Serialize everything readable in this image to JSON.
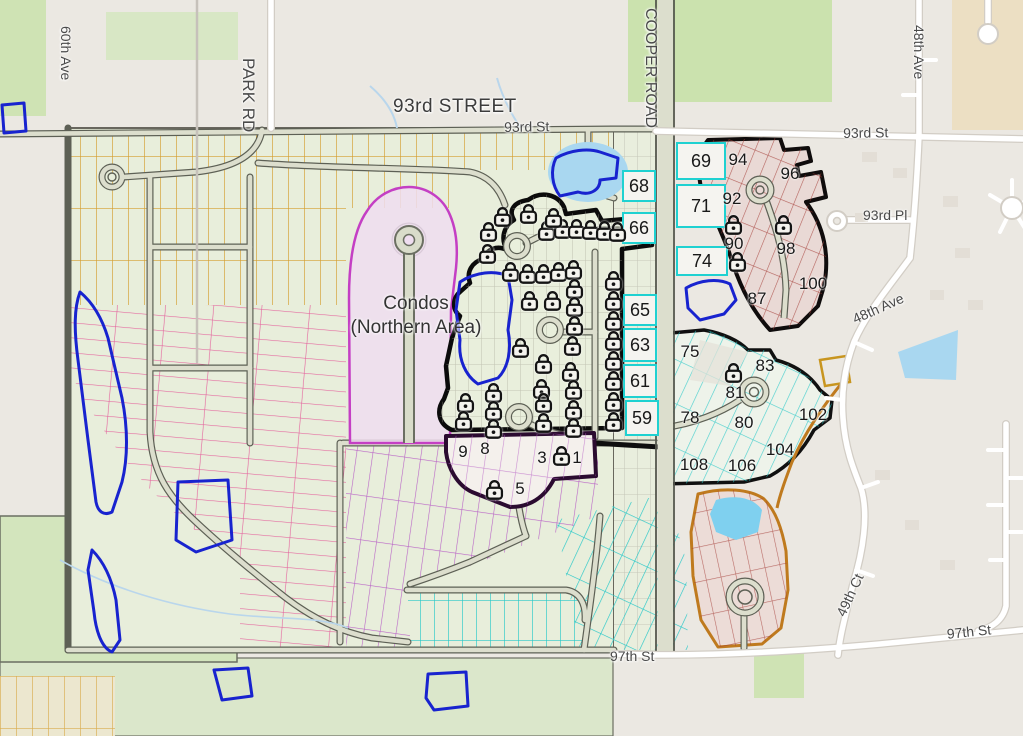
{
  "map_title": "Community site plan with lot availability",
  "colors": {
    "available_lot_border": "#1fd1d1",
    "locked_area_outline": "#0b0b0b",
    "condo_boundary": "#c43fc4",
    "red_phase_lines": "#9b2c2c",
    "orange_boundary": "#bf7a1e",
    "yellow_lot_lines": "#d49d2e",
    "pink_lot_lines": "#e4669e",
    "purple_lot_lines": "#b964c6",
    "pond_outline": "#1823cf",
    "water_fill": "#a9d7f0",
    "park_green": "#cfe3b4"
  },
  "area_labels": [
    {
      "id": "condos-northern-area",
      "text": "Condos\n(Northern Area)",
      "x": 336,
      "y": 292,
      "w": 160
    }
  ],
  "street_labels": [
    {
      "id": "60th-ave",
      "text": "60th Ave",
      "x": 74,
      "y": 26,
      "rot": 90,
      "size": 14
    },
    {
      "id": "park-rd",
      "text": "PARK RD",
      "x": 258,
      "y": 58,
      "rot": 90,
      "size": 17
    },
    {
      "id": "93rd-street",
      "text": "93rd STREET",
      "x": 393,
      "y": 96,
      "rot": 0,
      "size": 19,
      "big": true
    },
    {
      "id": "93rd-st-w",
      "text": "93rd St",
      "x": 504,
      "y": 119,
      "rot": -1,
      "size": 14
    },
    {
      "id": "cooper-road",
      "text": "COOPER ROAD",
      "x": 659,
      "y": 8,
      "rot": 90,
      "size": 16
    },
    {
      "id": "48th-ave-n",
      "text": "48th Ave",
      "x": 927,
      "y": 25,
      "rot": 90,
      "size": 14
    },
    {
      "id": "93rd-st-e",
      "text": "93rd St",
      "x": 843,
      "y": 125,
      "rot": -1,
      "size": 14
    },
    {
      "id": "93rd-pl",
      "text": "93rd Pl",
      "x": 863,
      "y": 207,
      "rot": 0,
      "size": 14
    },
    {
      "id": "48th-ave-s",
      "text": "48th Ave",
      "x": 850,
      "y": 312,
      "rot": -24,
      "size": 14
    },
    {
      "id": "49th-ct",
      "text": "49th Ct",
      "x": 833,
      "y": 612,
      "rot": -65,
      "size": 14
    },
    {
      "id": "97th-st-e",
      "text": "97th St",
      "x": 946,
      "y": 626,
      "rot": -6,
      "size": 14
    },
    {
      "id": "97th-st-w",
      "text": "97th St",
      "x": 610,
      "y": 648,
      "rot": 0,
      "size": 14
    }
  ],
  "available_lots": [
    {
      "num": "69",
      "x": 676,
      "y": 142,
      "w": 50,
      "h": 38,
      "style": "chip"
    },
    {
      "num": "71",
      "x": 676,
      "y": 184,
      "w": 50,
      "h": 44,
      "style": "chip"
    },
    {
      "num": "74",
      "x": 676,
      "y": 246,
      "w": 52,
      "h": 30,
      "style": "chip"
    },
    {
      "num": "68",
      "x": 622,
      "y": 170,
      "w": 34,
      "h": 32,
      "style": "chip"
    },
    {
      "num": "66",
      "x": 622,
      "y": 212,
      "w": 34,
      "h": 32,
      "style": "chip"
    },
    {
      "num": "65",
      "x": 623,
      "y": 294,
      "w": 34,
      "h": 32,
      "style": "chip"
    },
    {
      "num": "63",
      "x": 623,
      "y": 328,
      "w": 34,
      "h": 34,
      "style": "chip"
    },
    {
      "num": "61",
      "x": 623,
      "y": 364,
      "w": 34,
      "h": 34,
      "style": "chip"
    },
    {
      "num": "59",
      "x": 625,
      "y": 400,
      "w": 34,
      "h": 36,
      "style": "chip"
    },
    {
      "num": "94",
      "x": 720,
      "y": 148,
      "w": 36,
      "h": 24,
      "style": "plain"
    },
    {
      "num": "96",
      "x": 772,
      "y": 162,
      "w": 36,
      "h": 24,
      "style": "plain"
    },
    {
      "num": "92",
      "x": 714,
      "y": 187,
      "w": 36,
      "h": 24,
      "style": "plain"
    },
    {
      "num": "90",
      "x": 716,
      "y": 232,
      "w": 36,
      "h": 24,
      "style": "plain"
    },
    {
      "num": "98",
      "x": 768,
      "y": 237,
      "w": 36,
      "h": 24,
      "style": "plain"
    },
    {
      "num": "87",
      "x": 739,
      "y": 287,
      "w": 36,
      "h": 24,
      "style": "plain"
    },
    {
      "num": "100",
      "x": 790,
      "y": 272,
      "w": 46,
      "h": 24,
      "style": "plain"
    },
    {
      "num": "75",
      "x": 672,
      "y": 340,
      "w": 36,
      "h": 24,
      "style": "plain"
    },
    {
      "num": "83",
      "x": 747,
      "y": 354,
      "w": 36,
      "h": 24,
      "style": "plain"
    },
    {
      "num": "81",
      "x": 717,
      "y": 381,
      "w": 36,
      "h": 24,
      "style": "plain"
    },
    {
      "num": "78",
      "x": 672,
      "y": 406,
      "w": 36,
      "h": 24,
      "style": "plain"
    },
    {
      "num": "80",
      "x": 726,
      "y": 411,
      "w": 36,
      "h": 24,
      "style": "plain"
    },
    {
      "num": "102",
      "x": 789,
      "y": 403,
      "w": 48,
      "h": 24,
      "style": "plain"
    },
    {
      "num": "104",
      "x": 754,
      "y": 438,
      "w": 52,
      "h": 24,
      "style": "plain"
    },
    {
      "num": "106",
      "x": 716,
      "y": 454,
      "w": 52,
      "h": 24,
      "style": "plain"
    },
    {
      "num": "108",
      "x": 668,
      "y": 453,
      "w": 52,
      "h": 24,
      "style": "plain"
    },
    {
      "num": "9",
      "x": 452,
      "y": 440,
      "w": 22,
      "h": 24,
      "style": "plain"
    },
    {
      "num": "8",
      "x": 474,
      "y": 437,
      "w": 22,
      "h": 24,
      "style": "plain"
    },
    {
      "num": "3",
      "x": 531,
      "y": 446,
      "w": 22,
      "h": 24,
      "style": "plain"
    },
    {
      "num": "1",
      "x": 566,
      "y": 446,
      "w": 22,
      "h": 24,
      "style": "plain"
    },
    {
      "num": "5",
      "x": 509,
      "y": 477,
      "w": 22,
      "h": 24,
      "style": "plain"
    }
  ],
  "locked_lot_markers": [
    [
      502,
      216
    ],
    [
      528,
      213
    ],
    [
      488,
      231
    ],
    [
      546,
      230
    ],
    [
      562,
      228
    ],
    [
      576,
      228
    ],
    [
      590,
      229
    ],
    [
      604,
      230
    ],
    [
      617,
      231
    ],
    [
      553,
      217
    ],
    [
      487,
      253
    ],
    [
      510,
      271
    ],
    [
      527,
      273
    ],
    [
      543,
      273
    ],
    [
      558,
      271
    ],
    [
      573,
      269
    ],
    [
      613,
      280
    ],
    [
      613,
      300
    ],
    [
      613,
      320
    ],
    [
      613,
      340
    ],
    [
      613,
      360
    ],
    [
      613,
      380
    ],
    [
      613,
      401
    ],
    [
      613,
      421
    ],
    [
      574,
      288
    ],
    [
      574,
      306
    ],
    [
      574,
      325
    ],
    [
      572,
      345
    ],
    [
      570,
      371
    ],
    [
      573,
      389
    ],
    [
      573,
      409
    ],
    [
      573,
      427
    ],
    [
      529,
      300
    ],
    [
      552,
      300
    ],
    [
      520,
      347
    ],
    [
      543,
      363
    ],
    [
      541,
      388
    ],
    [
      543,
      402
    ],
    [
      543,
      422
    ],
    [
      493,
      392
    ],
    [
      465,
      402
    ],
    [
      493,
      410
    ],
    [
      463,
      420
    ],
    [
      493,
      428
    ],
    [
      733,
      224
    ],
    [
      783,
      224
    ],
    [
      737,
      261
    ],
    [
      733,
      372
    ],
    [
      561,
      455
    ],
    [
      494,
      489
    ]
  ],
  "legend_semantics": {
    "cyan_bordered_number": "available lot",
    "lock_icon": "unavailable / sold lot",
    "magenta_area": "Condos (Northern Area)"
  }
}
